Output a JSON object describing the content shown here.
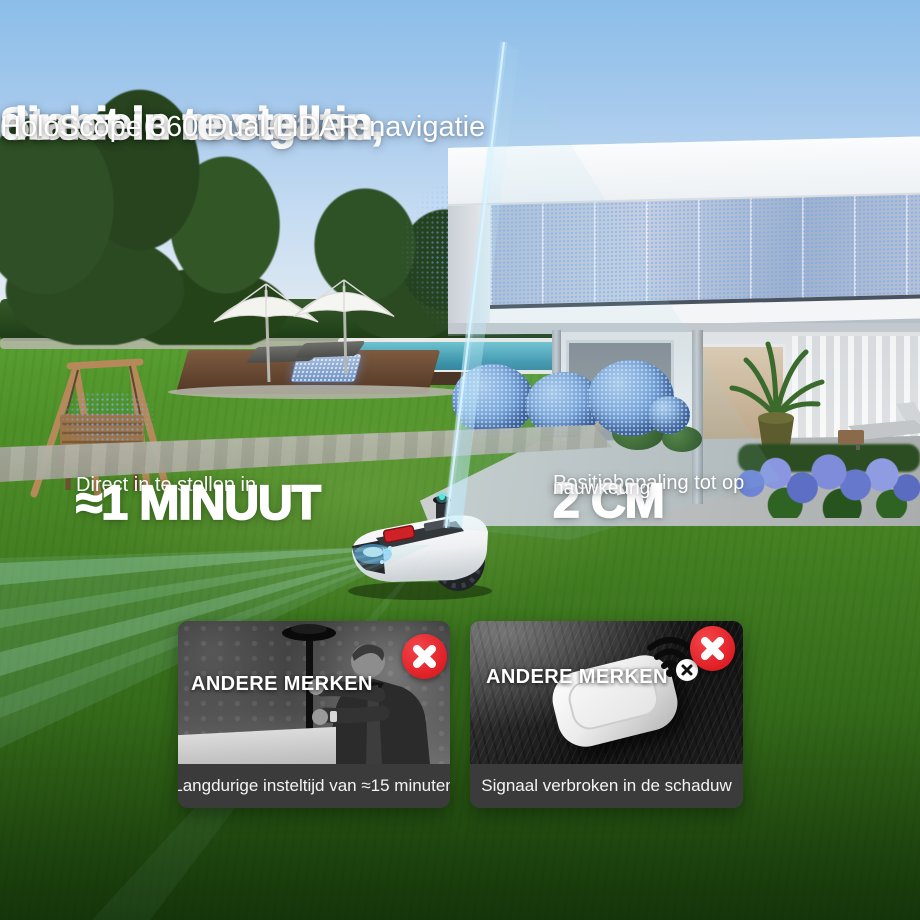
{
  "header": {
    "title_line1": "Stabiele navigatie,",
    "title_line2": "direct in te stellen",
    "subtitle": "HoloScope 360 Dual-LiDAR-navigatie"
  },
  "stats": {
    "setup": {
      "label": "Direct in te stellen in",
      "value": "≈1 MINUUT"
    },
    "accuracy": {
      "label": "Positiebepaling tot op",
      "value": "2 CM",
      "qualifier": "nauwkeurig"
    }
  },
  "cards": [
    {
      "title": "ANDERE MERKEN",
      "caption": "Langdurige insteltijd van ≈15 minuten",
      "status_icon": "x-circle-icon"
    },
    {
      "title": "ANDERE MERKEN",
      "caption": "Signaal verbroken in de schaduw",
      "status_icon": "x-circle-icon",
      "extra_icon": "wifi-off-icon"
    }
  ],
  "colors": {
    "accent_red": "#df1f26",
    "caption_bar": "#3b3b3b",
    "lidar_beam": "#aee6f5",
    "point_cloud_blue": "#5b8fd4"
  }
}
